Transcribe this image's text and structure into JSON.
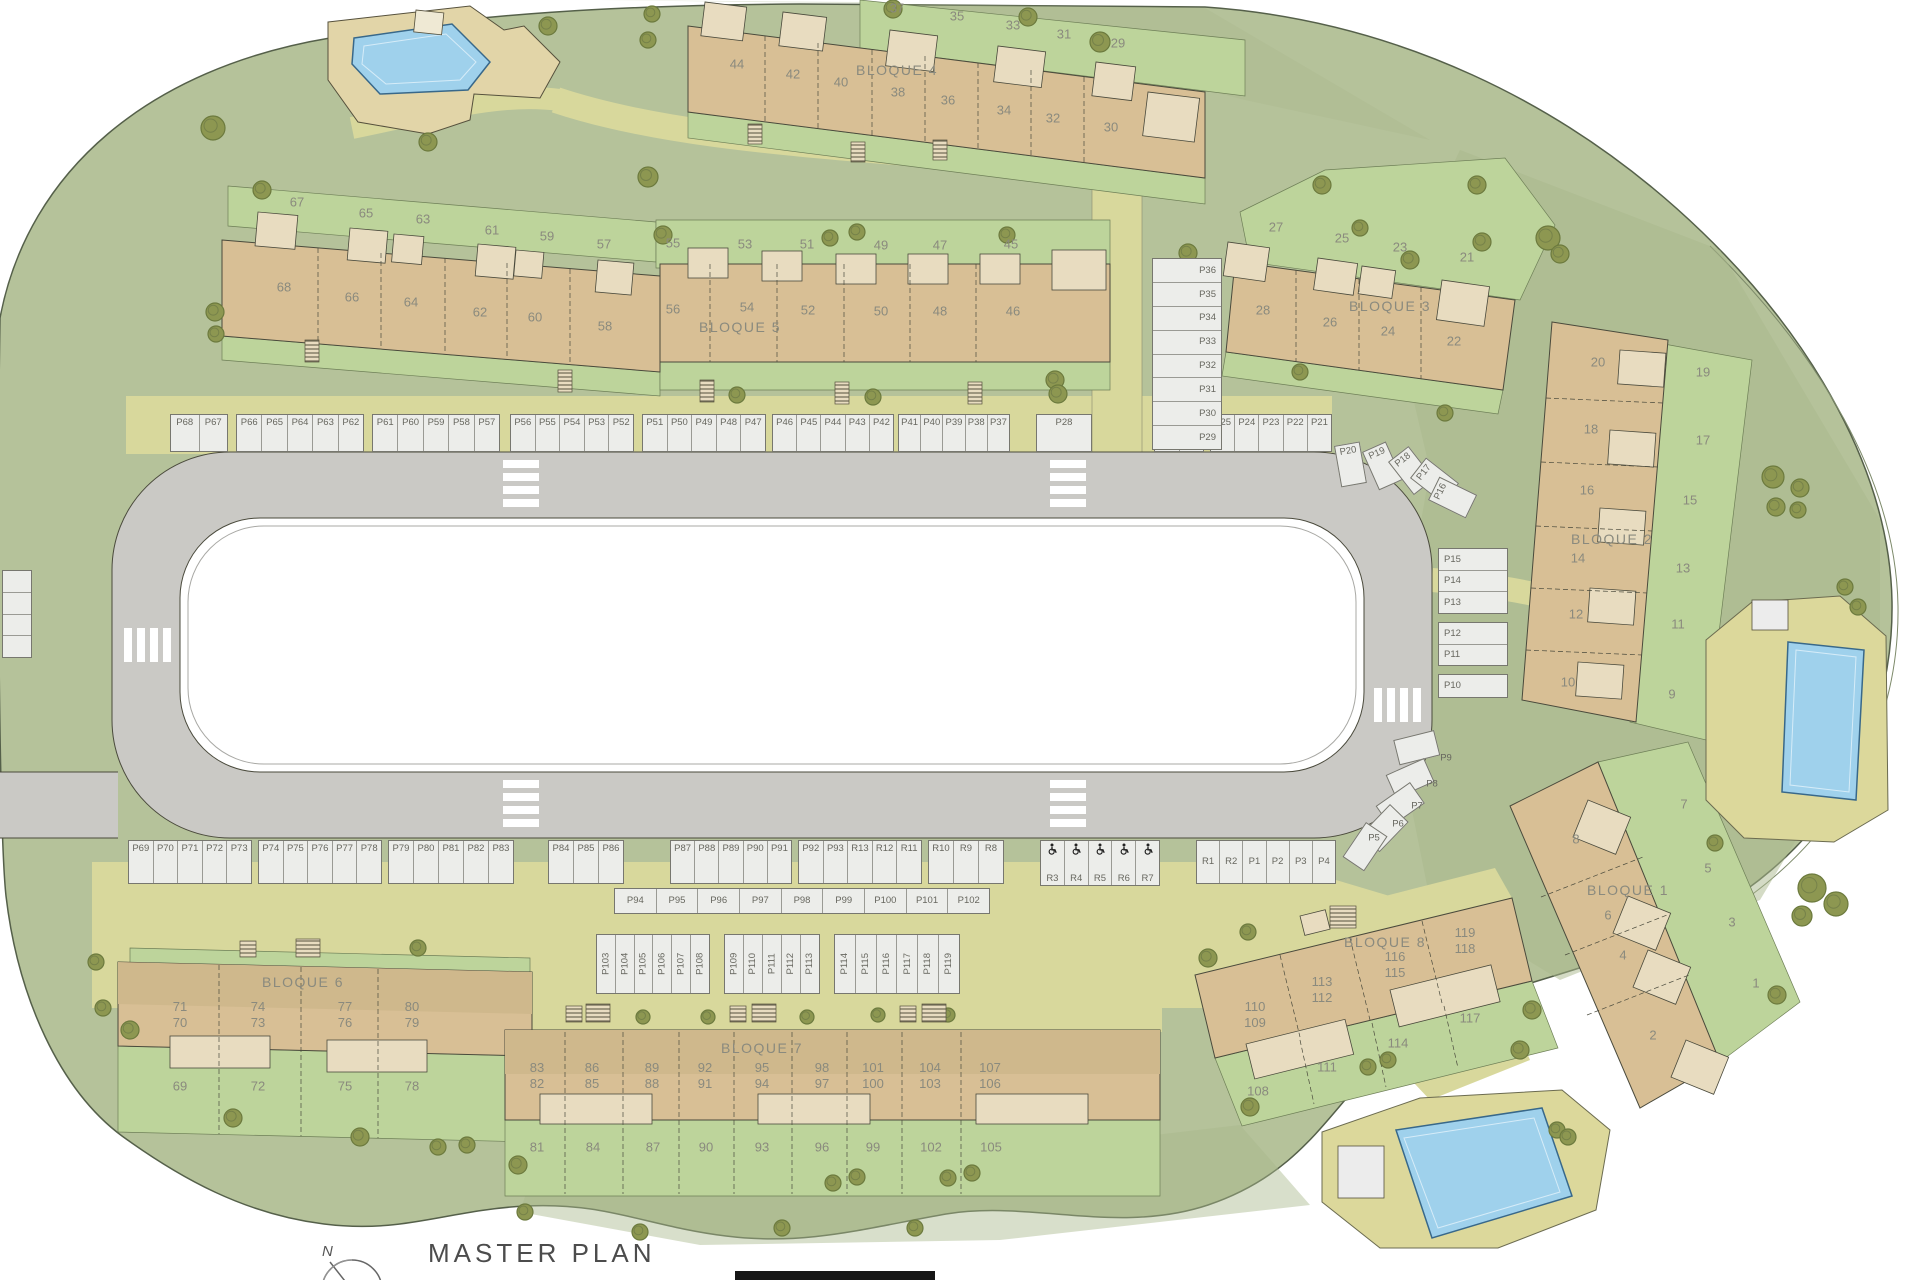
{
  "title": {
    "label": "MASTER PLAN",
    "north_label": "N"
  },
  "colors": {
    "site_green": "#b5c29a",
    "garden_green": "#bdd49b",
    "building_tan": "#d8bf95",
    "building_light": "#e8dcc0",
    "road_gray": "#cac9c5",
    "stall_fill": "#ecedea",
    "path_yellow": "#d8d89c",
    "pool_blue": "#9fd1ec",
    "tree_olive": "#8d9751",
    "label_gray": "#8a8a7e"
  },
  "blocks": [
    {
      "id": "bloque4",
      "label": "BLOQUE 4",
      "side_units": [
        "37",
        "35",
        "33",
        "31",
        "29"
      ],
      "main_units": [
        "44",
        "42",
        "40",
        "38",
        "36",
        "34",
        "32",
        "30"
      ]
    },
    {
      "id": "row_west",
      "label": "",
      "side_units": [
        "67",
        "65",
        "63",
        "61",
        "59",
        "57"
      ],
      "main_units": [
        "68",
        "66",
        "64",
        "62",
        "60",
        "58"
      ]
    },
    {
      "id": "bloque5",
      "label": "BLOQUE 5",
      "side_units": [
        "55",
        "53",
        "51",
        "49",
        "47",
        "45"
      ],
      "main_units": [
        "56",
        "54",
        "52",
        "50",
        "48",
        "46"
      ]
    },
    {
      "id": "bloque3",
      "label": "BLOQUE 3",
      "side_units": [
        "27",
        "25",
        "23",
        "21"
      ],
      "main_units": [
        "28",
        "26",
        "24",
        "22"
      ]
    },
    {
      "id": "bloque2",
      "label": "BLOQUE 2",
      "side_units": [
        "19",
        "17",
        "15",
        "13",
        "11",
        "9"
      ],
      "main_units": [
        "20",
        "18",
        "16",
        "14",
        "12",
        "10"
      ]
    },
    {
      "id": "bloque1",
      "label": "BLOQUE 1",
      "side_units": [
        "7",
        "5",
        "3",
        "1"
      ],
      "main_units": [
        "8",
        "6",
        "4",
        "2"
      ]
    },
    {
      "id": "bloque6",
      "label": "BLOQUE 6",
      "unit_pairs": [
        [
          "71",
          "70"
        ],
        [
          "74",
          "73"
        ],
        [
          "77",
          "76"
        ],
        [
          "80",
          "79"
        ]
      ],
      "garden_units": [
        "69",
        "72",
        "75",
        "78"
      ]
    },
    {
      "id": "bloque7",
      "label": "BLOQUE 7",
      "unit_pairs": [
        [
          "83",
          "82"
        ],
        [
          "86",
          "85"
        ],
        [
          "89",
          "88"
        ],
        [
          "92",
          "91"
        ],
        [
          "95",
          "94"
        ],
        [
          "98",
          "97"
        ],
        [
          "101",
          "100"
        ],
        [
          "104",
          "103"
        ],
        [
          "107",
          "106"
        ]
      ],
      "garden_units": [
        "81",
        "84",
        "87",
        "90",
        "93",
        "96",
        "99",
        "102",
        "105"
      ]
    },
    {
      "id": "bloque8",
      "label": "BLOQUE 8",
      "unit_pairs": [
        [
          "110",
          "109"
        ],
        [
          "113",
          "112"
        ],
        [
          "116",
          "115"
        ],
        [
          "119",
          "118"
        ]
      ],
      "garden_units": [
        "108",
        "111",
        "114",
        "117"
      ]
    }
  ],
  "parking": {
    "top_row_groups": [
      [
        "P68",
        "P67"
      ],
      [
        "P66",
        "P65",
        "P64",
        "P63",
        "P62"
      ],
      [
        "P61",
        "P60",
        "P59",
        "P58",
        "P57"
      ],
      [
        "P56",
        "P55",
        "P54",
        "P53",
        "P52"
      ],
      [
        "P51",
        "P50",
        "P49",
        "P48",
        "P47"
      ],
      [
        "P46",
        "P45",
        "P44",
        "P43",
        "P42"
      ],
      [
        "P41",
        "P40",
        "P39",
        "P38",
        "P37"
      ]
    ],
    "top_right_groups": [
      [
        "P28"
      ],
      [
        "P27",
        "P26"
      ],
      [
        "P25",
        "P24",
        "P23",
        "P22",
        "P21"
      ]
    ],
    "curve_ne": [
      "P20",
      "P19",
      "P18",
      "P17",
      "P16"
    ],
    "col_west": [
      "P36",
      "P35",
      "P34",
      "P33",
      "P32",
      "P31",
      "P30",
      "P29"
    ],
    "col_east_groups": [
      [
        "P15",
        "P14",
        "P13"
      ],
      [
        "P12",
        "P11"
      ],
      [
        "P10"
      ]
    ],
    "curve_se": [
      "P9",
      "P8",
      "P7",
      "P6",
      "P5"
    ],
    "bottom_row_groups": [
      [
        "P69",
        "P70",
        "P71",
        "P72",
        "P73"
      ],
      [
        "P74",
        "P75",
        "P76",
        "P77",
        "P78"
      ],
      [
        "P79",
        "P80",
        "P81",
        "P82",
        "P83"
      ]
    ],
    "bottom_row2_groups": [
      [
        "P84",
        "P85",
        "P86"
      ],
      [
        "P87",
        "P88",
        "P89",
        "P90",
        "P91"
      ],
      [
        "P92",
        "P93",
        "R13",
        "R12",
        "R11"
      ],
      [
        "R10",
        "R9",
        "R8"
      ]
    ],
    "accessible_group": [
      "R3",
      "R4",
      "R5",
      "R6",
      "R7"
    ],
    "east_group": [
      "R1",
      "R2",
      "P1",
      "P2",
      "P3",
      "P4"
    ],
    "mid_row": [
      "P94",
      "P95",
      "P96",
      "P97",
      "P98",
      "P99",
      "P100",
      "P101",
      "P102"
    ],
    "south_groups": [
      [
        "P103",
        "P104",
        "P105",
        "P106",
        "P107",
        "P108"
      ],
      [
        "P109",
        "P110",
        "P111",
        "P112",
        "P113"
      ],
      [
        "P114",
        "P115",
        "P116",
        "P117",
        "P118",
        "P119"
      ]
    ]
  }
}
